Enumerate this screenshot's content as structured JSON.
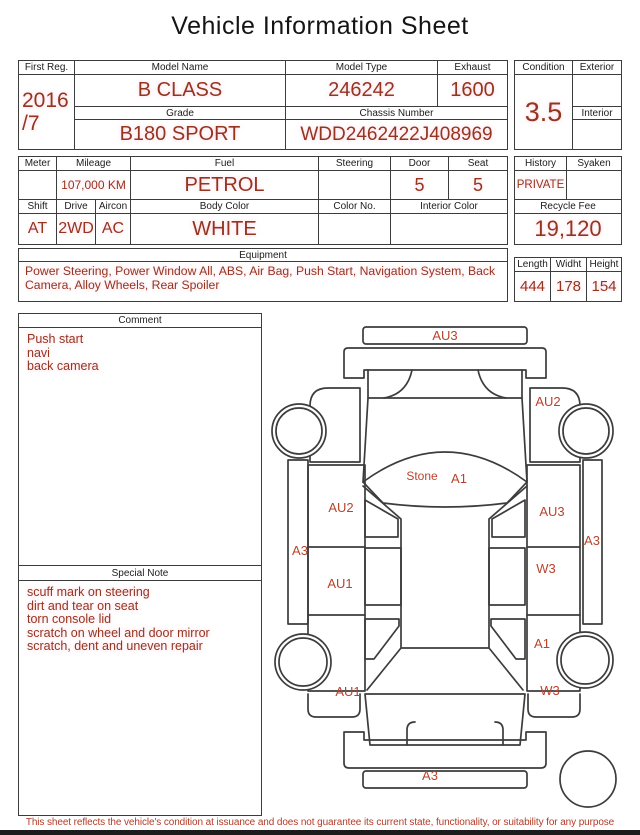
{
  "title": "Vehicle Information Sheet",
  "t1": {
    "first_reg": {
      "label": "First Reg.",
      "line1": "2016",
      "line2": "/7"
    },
    "model_name": {
      "label": "Model Name",
      "value": "B CLASS"
    },
    "model_type": {
      "label": "Model Type",
      "value": "246242"
    },
    "exhaust": {
      "label": "Exhaust",
      "value": "1600"
    },
    "grade": {
      "label": "Grade",
      "value": "B180 SPORT"
    },
    "chassis": {
      "label": "Chassis Number",
      "value": "WDD2462422J408969"
    },
    "condition": {
      "label": "Condition",
      "value": "3.5"
    },
    "exterior": {
      "label": "Exterior",
      "value": ""
    },
    "interior": {
      "label": "Interior",
      "value": ""
    }
  },
  "t2": {
    "meter": {
      "label": "Meter",
      "value": ""
    },
    "mileage": {
      "label": "Mileage",
      "value": "107,000 KM"
    },
    "fuel": {
      "label": "Fuel",
      "value": "PETROL"
    },
    "steering": {
      "label": "Steering",
      "value": ""
    },
    "door": {
      "label": "Door",
      "value": "5"
    },
    "seat": {
      "label": "Seat",
      "value": "5"
    },
    "history": {
      "label": "History",
      "value": "PRIVATE"
    },
    "syaken": {
      "label": "Syaken",
      "value": ""
    },
    "shift": {
      "label": "Shift",
      "value": "AT"
    },
    "drive": {
      "label": "Drive",
      "value": "2WD"
    },
    "aircon": {
      "label": "Aircon",
      "value": "AC"
    },
    "body_color": {
      "label": "Body Color",
      "value": "WHITE"
    },
    "color_no": {
      "label": "Color No.",
      "value": ""
    },
    "interior_color": {
      "label": "Interior Color",
      "value": ""
    },
    "recycle_fee": {
      "label": "Recycle Fee",
      "value": "19,120"
    }
  },
  "equipment": {
    "label": "Equipment",
    "text": "Power Steering, Power Window  All, ABS, Air Bag, Push Start, Navigation System, Back Camera, Alloy Wheels, Rear Spoiler"
  },
  "dims": {
    "length": {
      "label": "Length",
      "value": "444"
    },
    "width": {
      "label": "Widht",
      "value": "178"
    },
    "height": {
      "label": "Height",
      "value": "154"
    }
  },
  "comment": {
    "label": "Comment",
    "lines": [
      "Push start",
      "navi",
      "back camera"
    ]
  },
  "special_note": {
    "label": "Special Note",
    "lines": [
      "scuff mark on steering",
      "dirt and tear on seat",
      "torn console lid",
      "scratch on wheel and door mirror",
      "scratch, dent and uneven repair"
    ]
  },
  "diagram": {
    "labels": [
      {
        "text": "AU3"
      },
      {
        "text": "AU2"
      },
      {
        "text": "Stone"
      },
      {
        "text": "A1"
      },
      {
        "text": "AU2"
      },
      {
        "text": "AU3"
      },
      {
        "text": "A3"
      },
      {
        "text": "A3"
      },
      {
        "text": "W3"
      },
      {
        "text": "AU1"
      },
      {
        "text": "A1"
      },
      {
        "text": "AU1"
      },
      {
        "text": "W3"
      },
      {
        "text": "A3"
      }
    ]
  },
  "footer": {
    "disclaimer": "This sheet reflects the vehicle's condition at issuance and does not guarantee its current state, functionality, or suitability for any purpose"
  },
  "colors": {
    "value_red": "#93351f",
    "diagram_label_red": "#b8432c",
    "line": "#3c3c3c"
  }
}
